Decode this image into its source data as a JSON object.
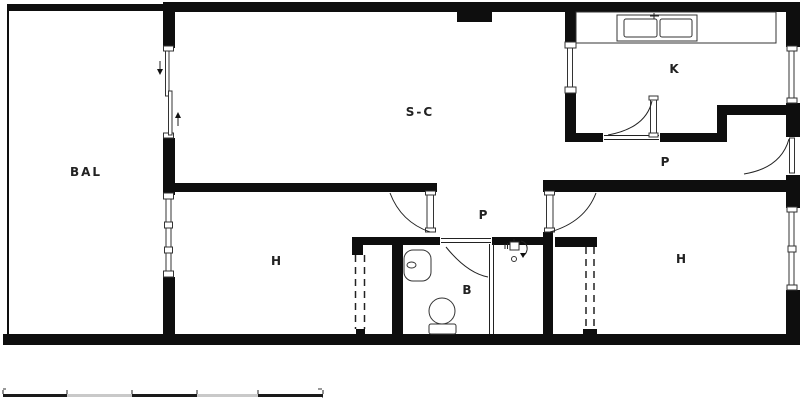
{
  "drawing": {
    "type": "apartment-floor-plan",
    "rooms": [
      {
        "id": "balcony",
        "label": "BAL"
      },
      {
        "id": "living-room",
        "label": "S-C"
      },
      {
        "id": "kitchen",
        "label": "K"
      },
      {
        "id": "hallway-upper",
        "label": "P"
      },
      {
        "id": "hallway-lower",
        "label": "P"
      },
      {
        "id": "bathroom",
        "label": "B"
      },
      {
        "id": "bedroom-left",
        "label": "H"
      },
      {
        "id": "bedroom-right",
        "label": "H"
      }
    ],
    "icons": {
      "slide_down_arrow": "↓",
      "slide_up_arrow": "↑"
    },
    "colors": {
      "wall": "#0e0e0e",
      "line": "#222222",
      "scale_dark": "#1a1a1a",
      "scale_light": "#c9c9c9",
      "background": "#ffffff"
    }
  }
}
